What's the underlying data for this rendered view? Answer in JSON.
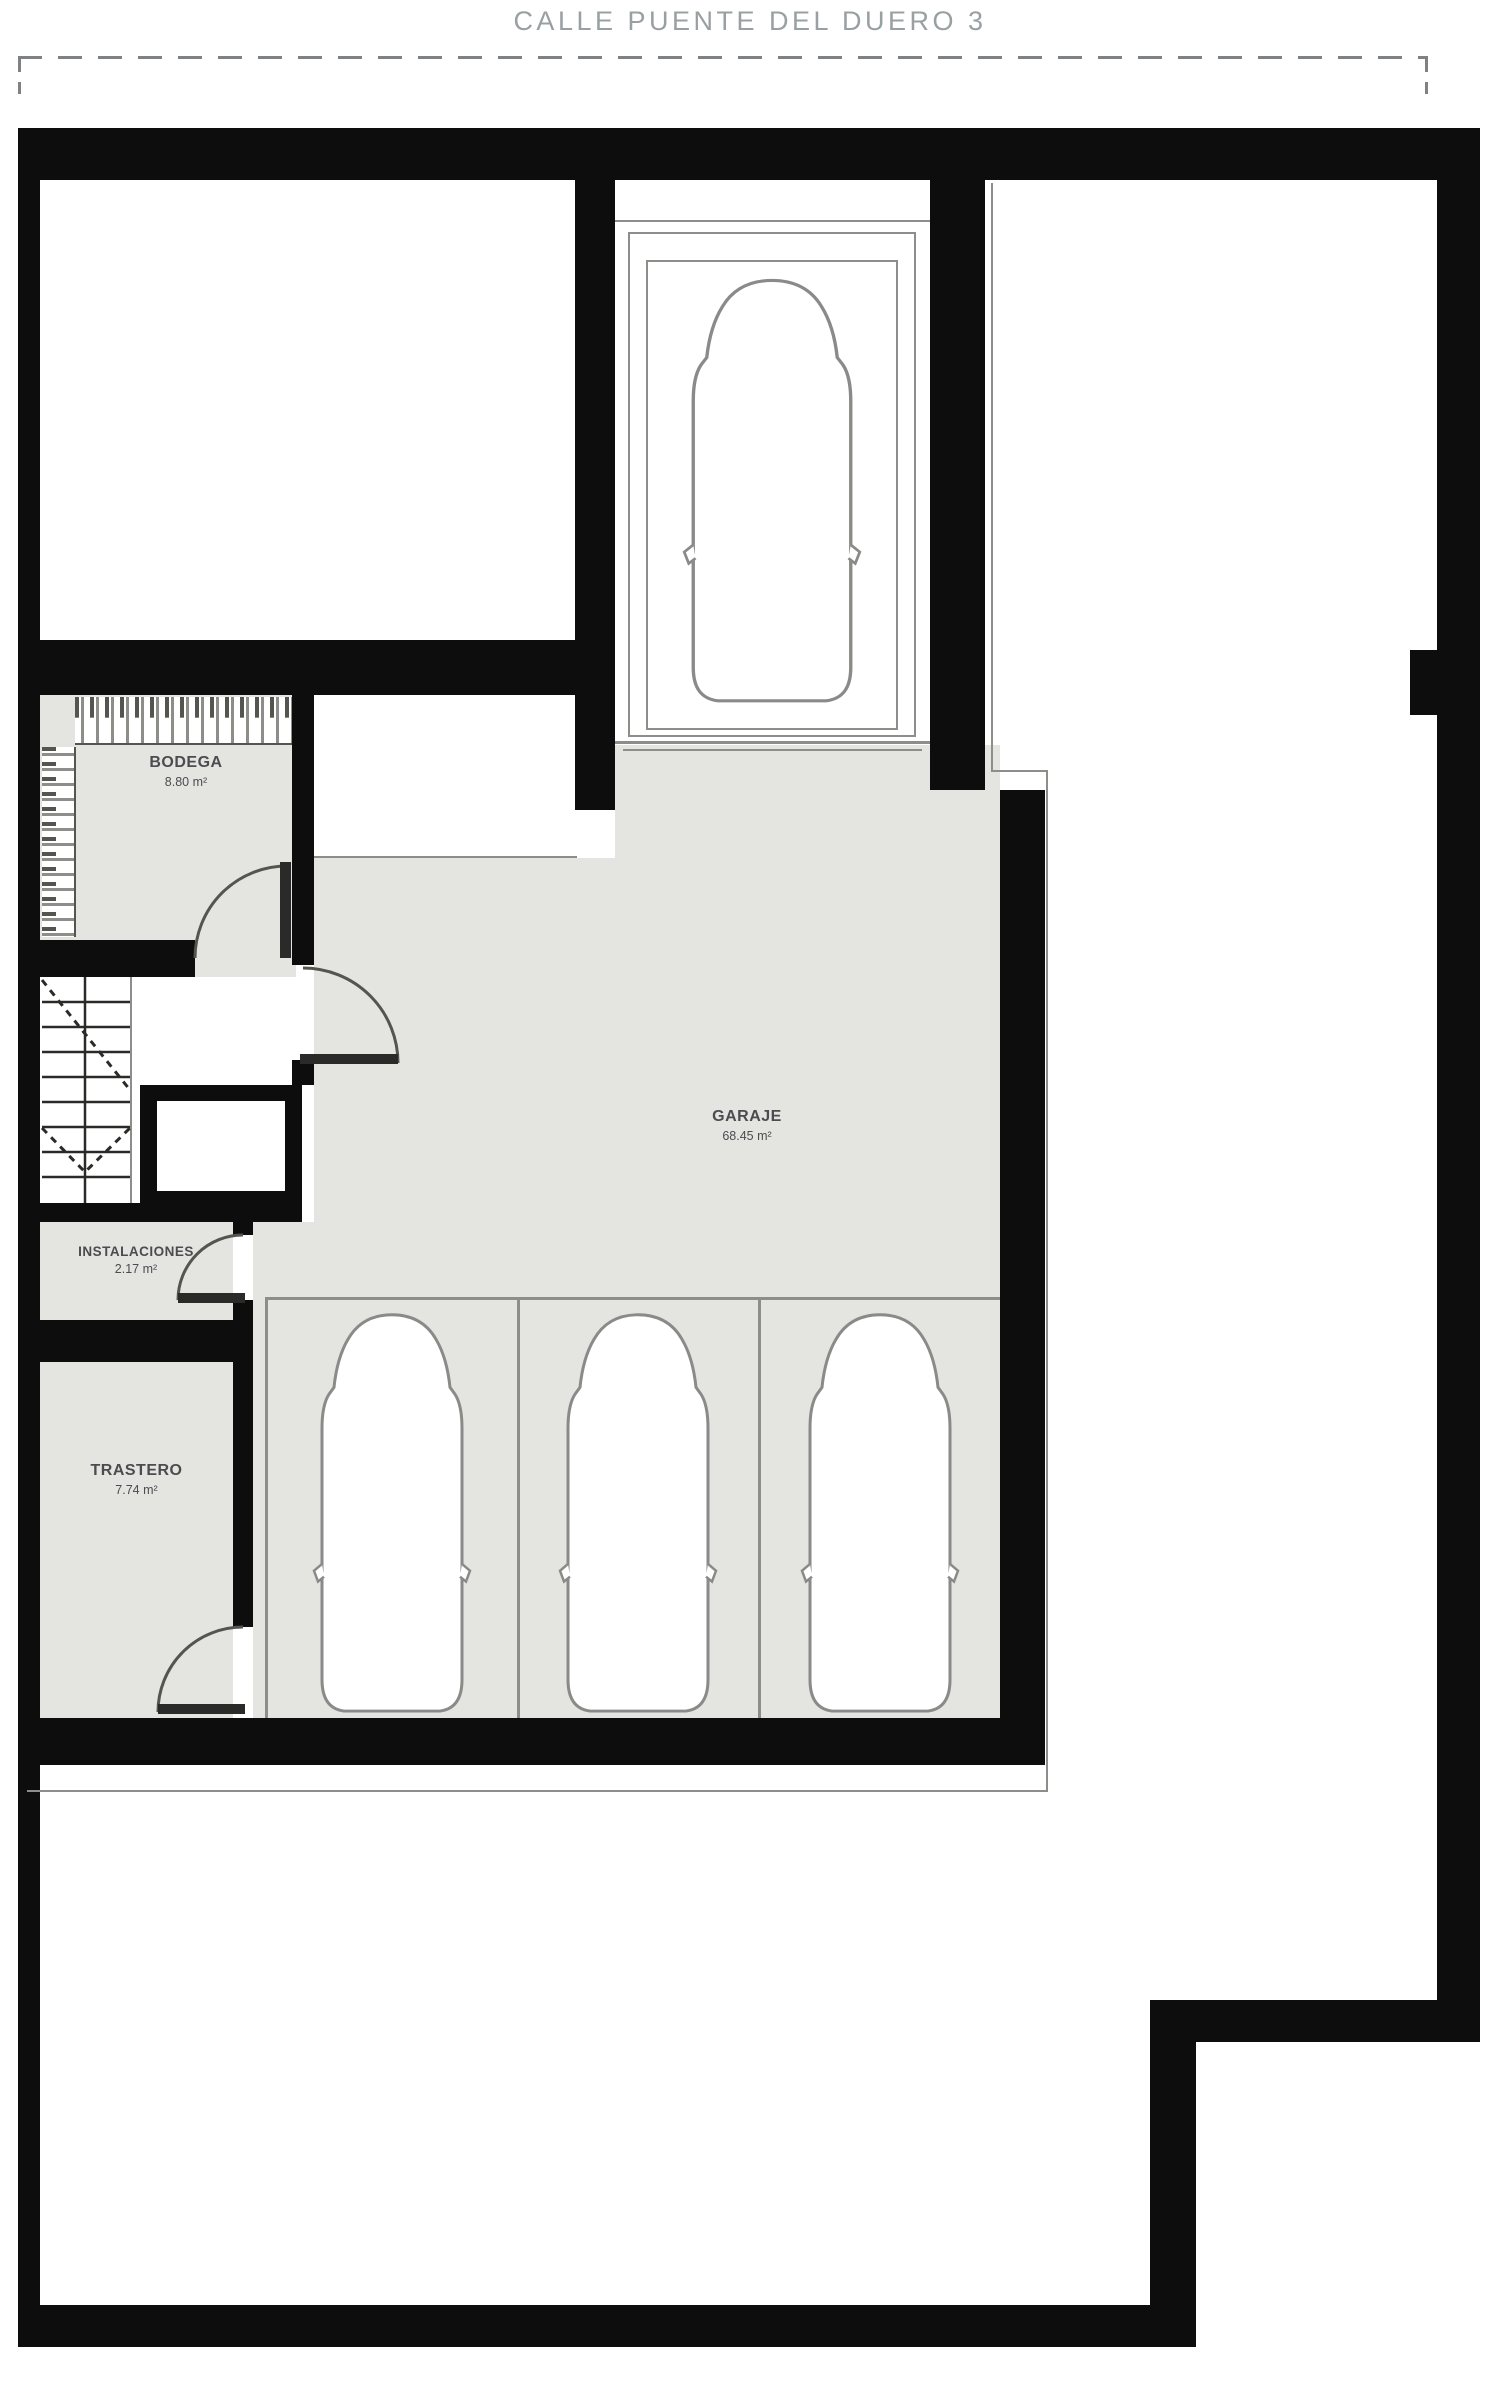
{
  "header": {
    "title": "CALLE PUENTE DEL DUERO 3"
  },
  "plan": {
    "level": "basement-garage-floorplan",
    "rooms": [
      {
        "id": "bodega",
        "name": "BODEGA",
        "area": "8.80 m²"
      },
      {
        "id": "garaje",
        "name": "GARAJE",
        "area": "68.45 m²"
      },
      {
        "id": "instalaciones",
        "name": "INSTALACIONES",
        "area": "2.17 m²"
      },
      {
        "id": "trastero",
        "name": "TRASTERO",
        "area": "7.74 m²"
      }
    ],
    "features": [
      "car-ramp",
      "staircase",
      "elevator-shaft",
      "three-parking-bays",
      "four-doors",
      "wine-racks",
      "dashed-street-boundary"
    ],
    "colors": {
      "wall": "#0d0d0d",
      "floor": "#e4e4e1",
      "line": "#8d8d89",
      "label": "#4c4c50",
      "title": "#98a0a2",
      "background": "#ffffff"
    },
    "cars": {
      "count": 4,
      "ramp": 1,
      "parking_bays": 3
    }
  }
}
